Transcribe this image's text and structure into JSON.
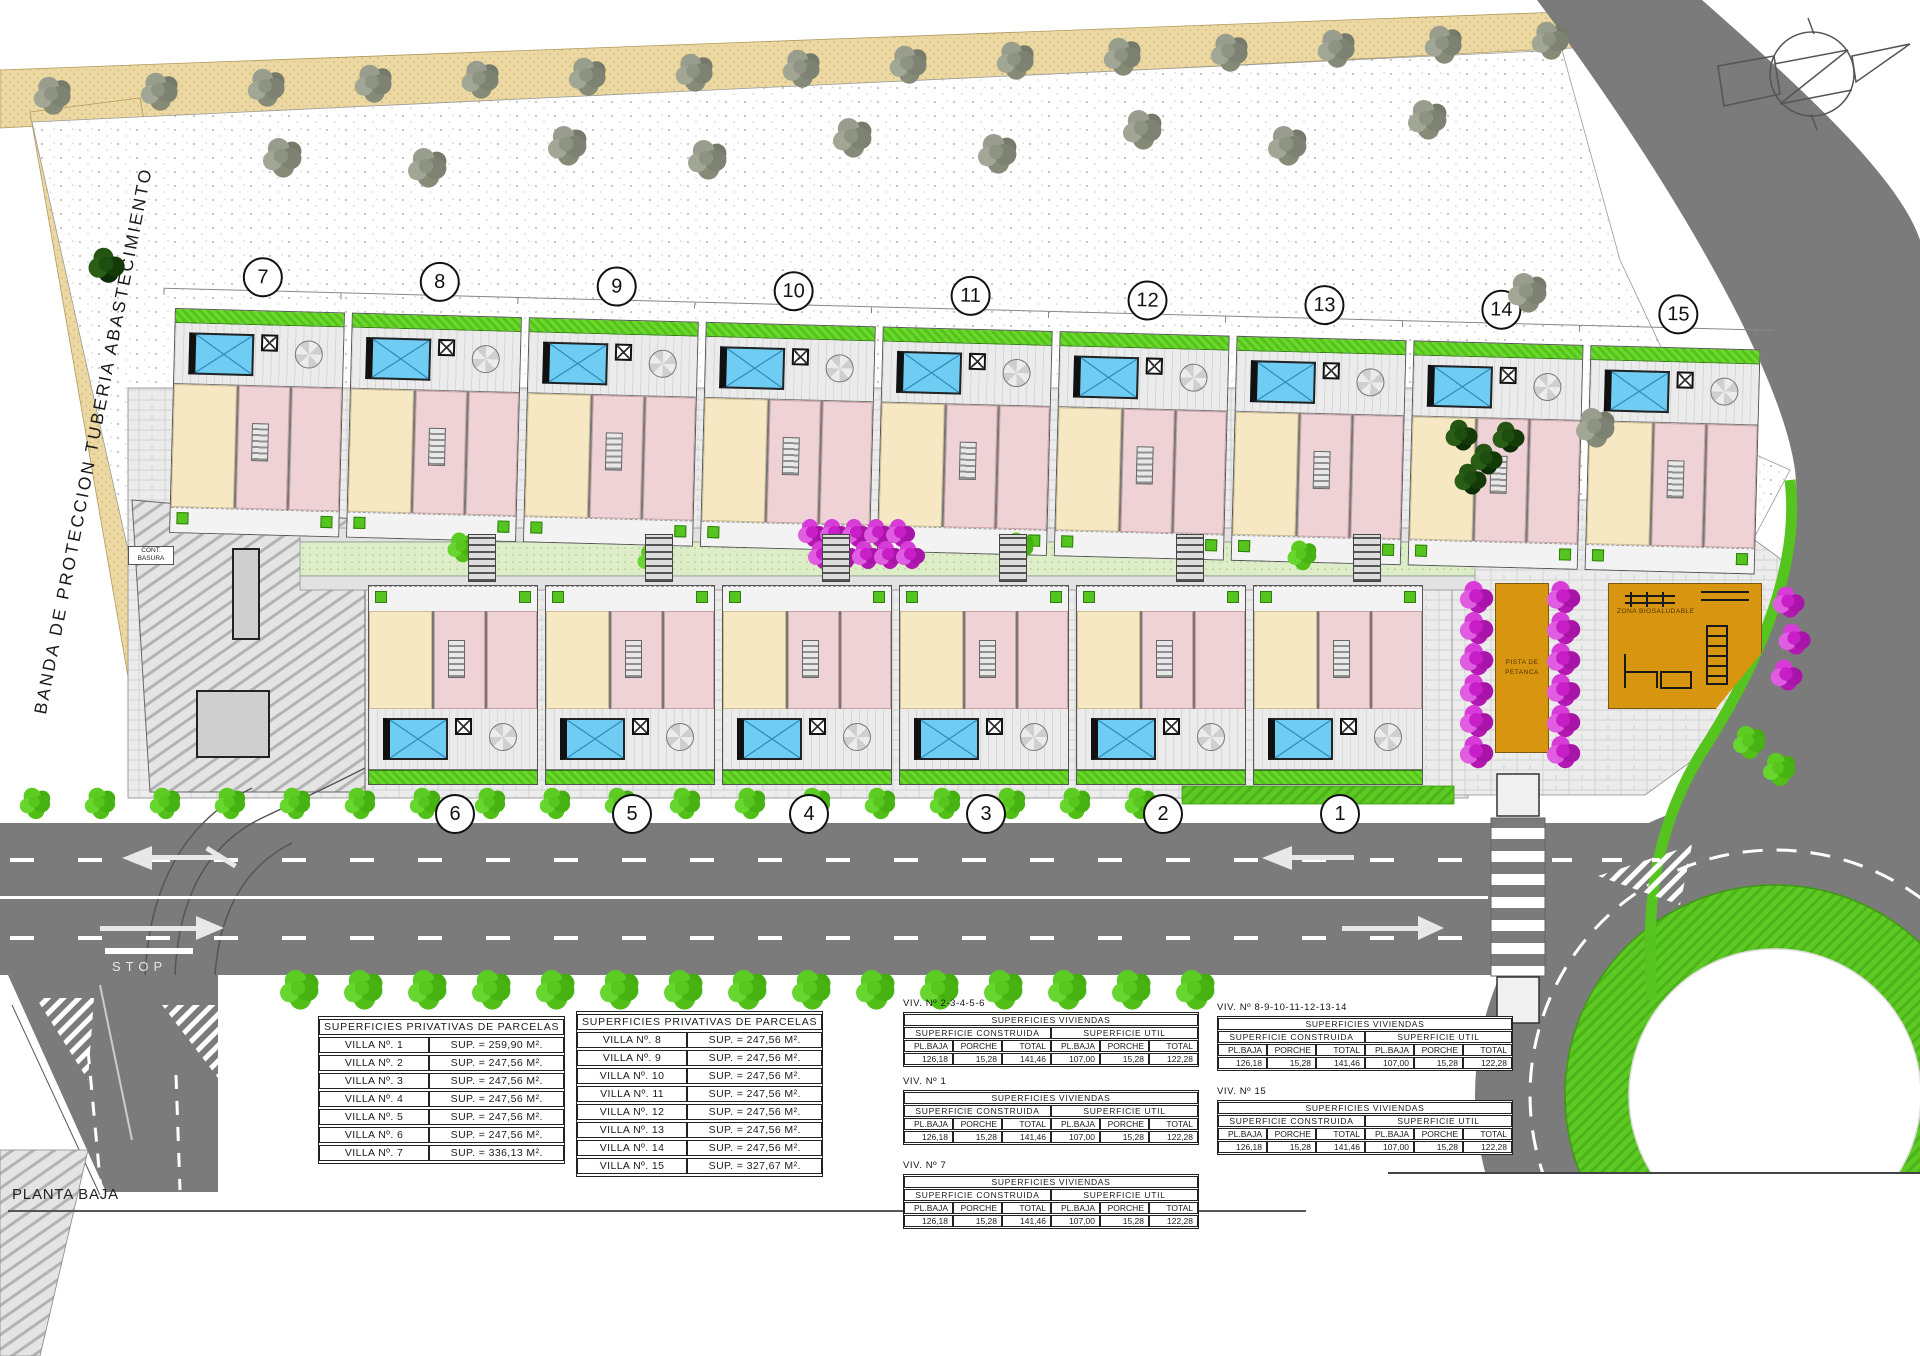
{
  "labels": {
    "plan_title": "PLANTA BAJA",
    "stop": "STOP",
    "protection_band": "BANDA DE PROTECCION TUBERIA ABASTECIMIENTO",
    "petanca_line1": "PISTA DE",
    "petanca_line2": "PETANCA",
    "playground": "ZONA BIOSALUDABLE",
    "waste_line1": "CONT.",
    "waste_line2": "BASURA"
  },
  "villas_top": [
    "7",
    "8",
    "9",
    "10",
    "11",
    "12",
    "13",
    "14",
    "15"
  ],
  "villas_bottom": [
    "6",
    "5",
    "4",
    "3",
    "2",
    "1"
  ],
  "parcel_tables": [
    {
      "title": "SUPERFICIES PRIVATIVAS DE PARCELAS",
      "rows": [
        [
          "VILLA Nº. 1",
          "SUP. = 259,90 M²."
        ],
        [
          "VILLA Nº. 2",
          "SUP. = 247,56 M²."
        ],
        [
          "VILLA Nº. 3",
          "SUP. = 247,56 M²."
        ],
        [
          "VILLA Nº. 4",
          "SUP. = 247,56 M²."
        ],
        [
          "VILLA Nº. 5",
          "SUP. = 247,56 M²."
        ],
        [
          "VILLA Nº. 6",
          "SUP. = 247,56 M²."
        ],
        [
          "VILLA Nº. 7",
          "SUP. = 336,13 M²."
        ]
      ]
    },
    {
      "title": "SUPERFICIES PRIVATIVAS DE PARCELAS",
      "rows": [
        [
          "VILLA Nº. 8",
          "SUP. = 247,56 M²."
        ],
        [
          "VILLA Nº. 9",
          "SUP. = 247,56 M²."
        ],
        [
          "VILLA Nº. 10",
          "SUP. = 247,56 M²."
        ],
        [
          "VILLA Nº. 11",
          "SUP. = 247,56 M²."
        ],
        [
          "VILLA Nº. 12",
          "SUP. = 247,56 M²."
        ],
        [
          "VILLA Nº. 13",
          "SUP. = 247,56 M²."
        ],
        [
          "VILLA Nº. 14",
          "SUP. = 247,56 M²."
        ],
        [
          "VILLA Nº. 15",
          "SUP. = 327,67 M²."
        ]
      ]
    }
  ],
  "dwelling_tables": [
    {
      "label": "VIV. Nº 2-3-4-5-6",
      "title": "SUPERFICIES VIVIENDAS",
      "group1": "SUPERFICIE CONSTRUIDA",
      "group2": "SUPERFICIE UTIL",
      "cols": [
        "PL.BAJA",
        "PORCHE",
        "TOTAL",
        "PL.BAJA",
        "PORCHE",
        "TOTAL"
      ],
      "values": [
        "126,18",
        "15,28",
        "141,46",
        "107,00",
        "15,28",
        "122,28"
      ]
    },
    {
      "label": "VIV. Nº 1",
      "title": "SUPERFICIES VIVIENDAS",
      "group1": "SUPERFICIE CONSTRUIDA",
      "group2": "SUPERFICIE UTIL",
      "cols": [
        "PL.BAJA",
        "PORCHE",
        "TOTAL",
        "PL.BAJA",
        "PORCHE",
        "TOTAL"
      ],
      "values": [
        "126,18",
        "15,28",
        "141,46",
        "107,00",
        "15,28",
        "122,28"
      ]
    },
    {
      "label": "VIV. Nº 7",
      "title": "SUPERFICIES VIVIENDAS",
      "group1": "SUPERFICIE CONSTRUIDA",
      "group2": "SUPERFICIE UTIL",
      "cols": [
        "PL.BAJA",
        "PORCHE",
        "TOTAL",
        "PL.BAJA",
        "PORCHE",
        "TOTAL"
      ],
      "values": [
        "126,18",
        "15,28",
        "141,46",
        "107,00",
        "15,28",
        "122,28"
      ]
    },
    {
      "label": "VIV. Nº 8-9-10-11-12-13-14",
      "title": "SUPERFICIES VIVIENDAS",
      "group1": "SUPERFICIE CONSTRUIDA",
      "group2": "SUPERFICIE UTIL",
      "cols": [
        "PL.BAJA",
        "PORCHE",
        "TOTAL",
        "PL.BAJA",
        "PORCHE",
        "TOTAL"
      ],
      "values": [
        "126,18",
        "15,28",
        "141,46",
        "107,00",
        "15,28",
        "122,28"
      ]
    },
    {
      "label": "VIV. Nº 15",
      "title": "SUPERFICIES VIVIENDAS",
      "group1": "SUPERFICIE CONSTRUIDA",
      "group2": "SUPERFICIE UTIL",
      "cols": [
        "PL.BAJA",
        "PORCHE",
        "TOTAL",
        "PL.BAJA",
        "PORCHE",
        "TOTAL"
      ],
      "values": [
        "126,18",
        "15,28",
        "141,46",
        "107,00",
        "15,28",
        "122,28"
      ]
    }
  ],
  "colors": {
    "road": "#7b7b7b",
    "grass": "#5ac520",
    "pool": "#6fccf2",
    "court": "#d8950f",
    "flowers": "#c81ec8",
    "sidewalk": "#ecd8a2",
    "bedroom": "#eed2d6",
    "living": "#f6e8c3"
  }
}
